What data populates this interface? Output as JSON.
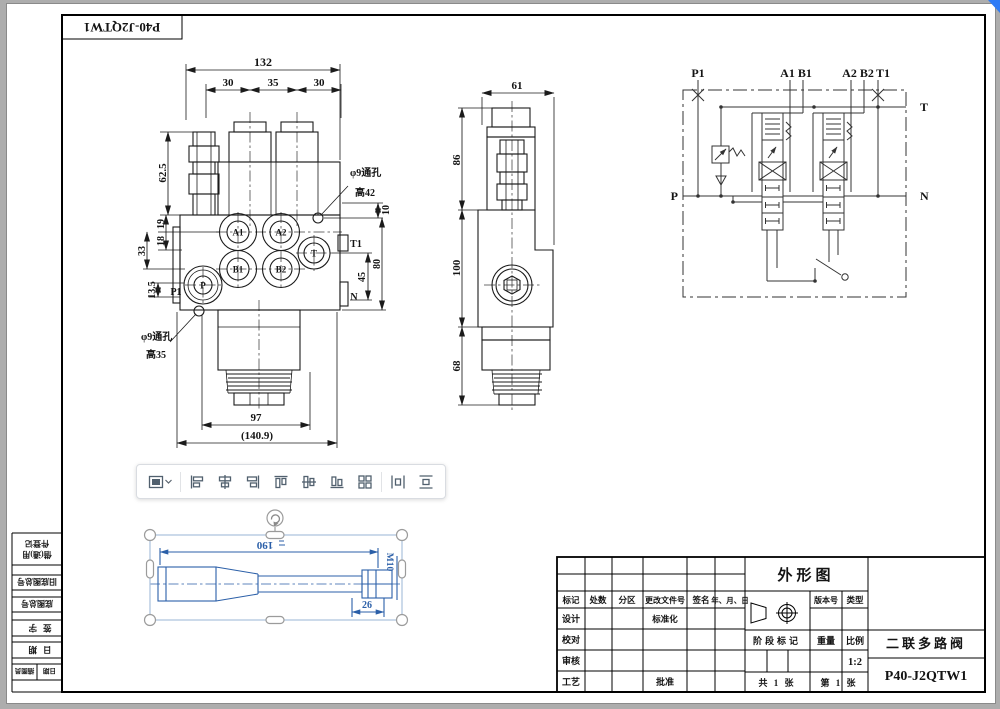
{
  "corner_label": "P40-J2QTW1",
  "front_view": {
    "d132": "132",
    "d30a": "30",
    "d35": "35",
    "d30b": "30",
    "d62_5": "62.5",
    "d19": "19",
    "d18": "18",
    "d33": "33",
    "d13_5": "13.5",
    "d97": "97",
    "d140_9": "(140.9)",
    "d10": "10",
    "d45": "45",
    "d80": "80",
    "a1": "A1",
    "a2": "A2",
    "b1": "B1",
    "b2": "B2",
    "t": "T",
    "p": "P",
    "p1": "P1",
    "t1": "T1",
    "n": "N",
    "note_top_1": "φ9通孔",
    "note_top_2": "高42",
    "note_bot_1": "φ9通孔",
    "note_bot_2": "高35"
  },
  "side_view": {
    "d61": "61",
    "d86": "86",
    "d100": "100",
    "d68": "68"
  },
  "schematic": {
    "p1": "P1",
    "a1b1": "A1 B1",
    "a2b2": "A2 B2",
    "t1": "T1",
    "t": "T",
    "n": "N",
    "p": "P"
  },
  "selected_object": {
    "len": "190",
    "thread": "M10",
    "width26": "26"
  },
  "margin_block": {
    "row1a": "借(通)用",
    "row1b": "件登记",
    "row2": "旧底图总号",
    "row3": "底图总号",
    "row4": "签字",
    "row5": "日期",
    "row6a": "描图员",
    "row6b": "日期"
  },
  "title_block": {
    "name": "外形图",
    "headers": [
      "标记",
      "处数",
      "分区",
      "更改文件号",
      "签名",
      "年、月、日"
    ],
    "left_rows": [
      "设计",
      "校对",
      "审核",
      "工艺"
    ],
    "standardize": "标准化",
    "approve": "批准",
    "version": "版本号",
    "type": "类型",
    "stage": "阶段标记",
    "weight": "重量",
    "scale": "比例",
    "scale_value": "1:2",
    "sheet_total": "共 1 张",
    "sheet_no": "第 1 张",
    "product": "二联多路阀",
    "code": "P40-J2QTW1"
  },
  "toolbar": {
    "buttons": [
      "layout-options",
      "align-left",
      "align-horizontal-center",
      "align-right",
      "align-top",
      "align-vertical-center",
      "align-bottom",
      "snap-to-grid",
      "distribute-horizontal",
      "distribute-vertical"
    ]
  },
  "colors": {
    "selection_blue": "#2b5fa8",
    "wedge_blue": "#2e7bf6",
    "icon_gray": "#51606e"
  }
}
